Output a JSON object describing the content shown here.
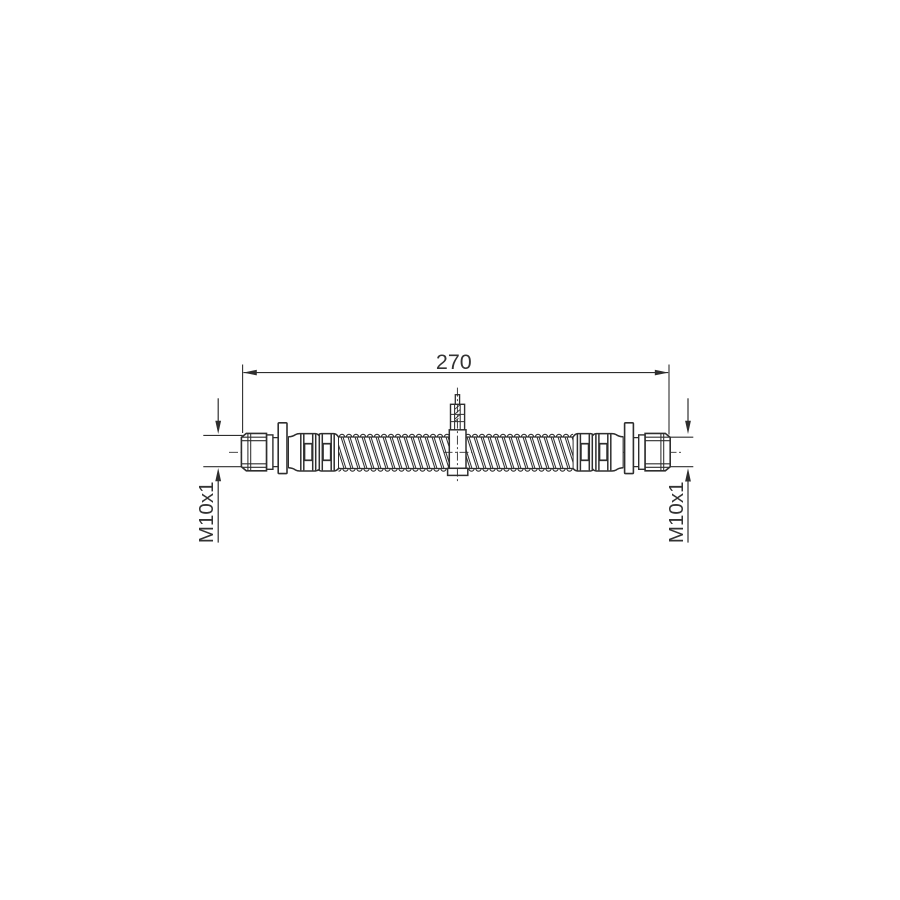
{
  "page": {
    "background": "#ffffff"
  },
  "drawing": {
    "type": "technical-drawing",
    "subject": "brake-hose-side-view",
    "line_color": "#2e2e2e",
    "text_color": "#333333",
    "dimension": {
      "length_label": "270"
    },
    "thread_callouts": {
      "left_label": "M10x1",
      "right_label": "M10x1"
    }
  }
}
